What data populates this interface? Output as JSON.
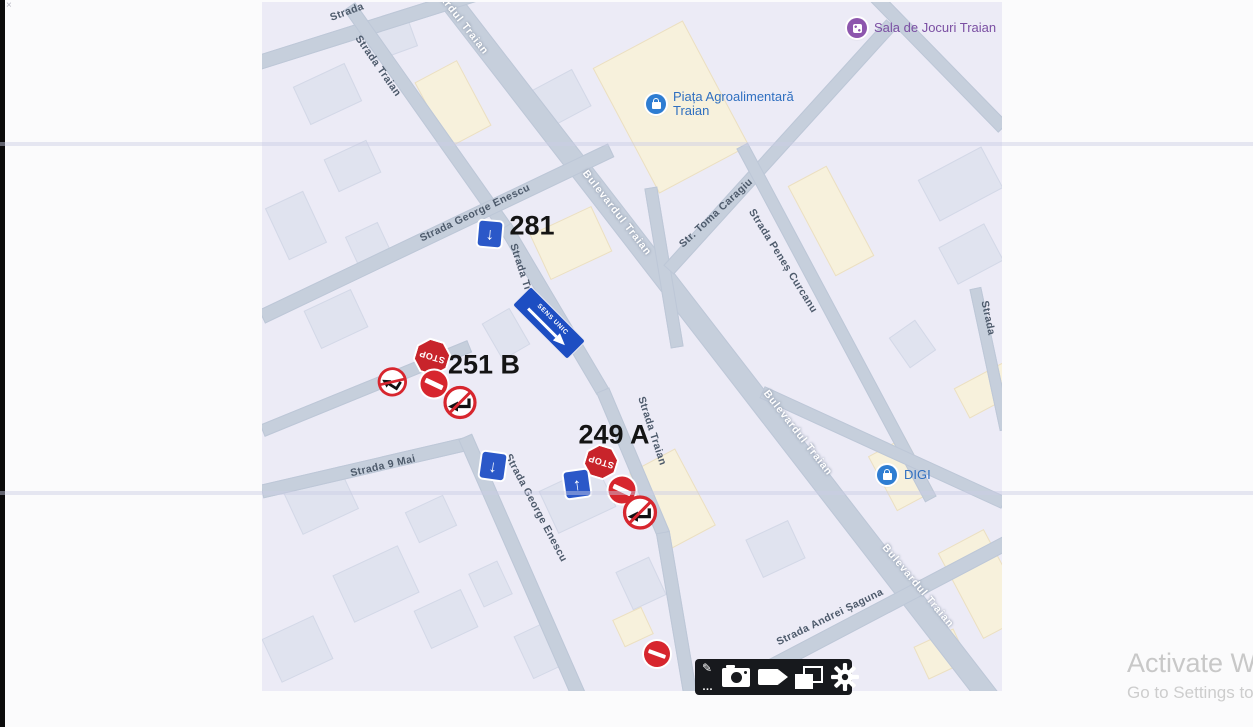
{
  "scan": {
    "corner_mark": "×"
  },
  "watermark": {
    "line1": "Activate Win",
    "line2": "Go to Settings to"
  },
  "toolbar": {
    "ellipsis": "…",
    "icons": [
      "pen-icon",
      "camera-icon",
      "video-camera-icon",
      "layers-icon",
      "gear-icon"
    ]
  },
  "map": {
    "addresses": [
      "281",
      "251 B",
      "249 A"
    ],
    "street_labels": [
      "Strada",
      "Strada Traian",
      "Strada George Enescu",
      "Strada Traian",
      "Bulevardul Traian",
      "Bulevardul Traian",
      "Str. Toma Caragiu",
      "Strada Peneș Curcanu",
      "Strada Traian",
      "Strada 9 Mai",
      "Strada George Enescu",
      "Bulevardul Traian",
      "Bulevardul Traian",
      "Strada Andrei Șaguna",
      "Strada"
    ],
    "pois": [
      {
        "label": "Sala de Jocuri Traian"
      },
      {
        "line1": "Piața Agroalimentară",
        "line2": "Traian"
      },
      {
        "label": "DIGI"
      }
    ],
    "signs": {
      "stop_text": "STOP",
      "one_way_panel_text": "SENS UNIC",
      "types": [
        "stop",
        "no-entry",
        "no-left-turn",
        "no-right-turn",
        "one-way-arrow",
        "one-way-panel"
      ]
    },
    "colors": {
      "map_bg": "#ecebf6",
      "road": "#c6cfdc",
      "building": "#e0e3ef",
      "building_alt": "#f7f1dc",
      "sign_red": "#d7262e",
      "sign_blue": "#2b58c8",
      "poi_purple": "#8d56ad",
      "poi_blue": "#2e7dd2",
      "street_label": "#4d5a6b",
      "watermark": "#c8c8c8"
    }
  }
}
